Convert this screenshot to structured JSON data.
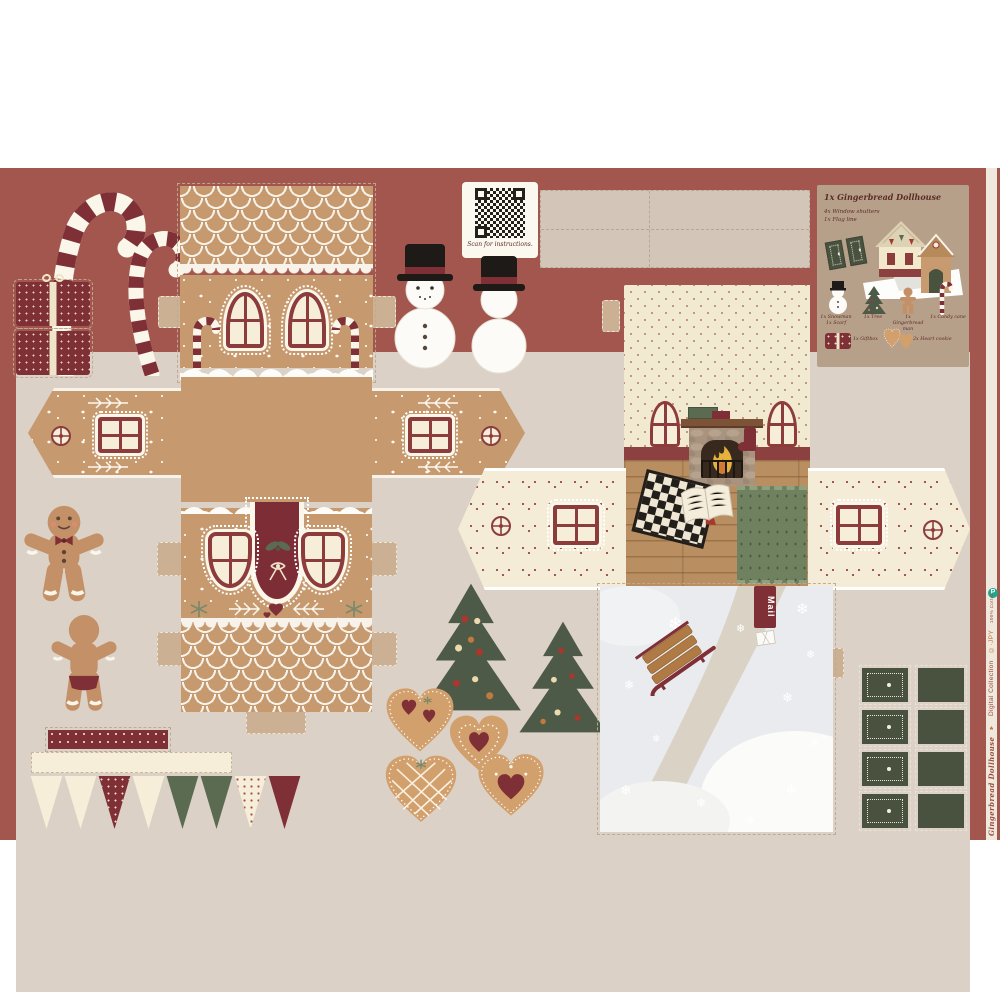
{
  "colors": {
    "border": "#a2564e",
    "panel_bg": "#dcd1c6",
    "gingerbread_tan": "#c6996f",
    "maroon": "#7f2f36",
    "window_frame": "#8d3c3c",
    "cream": "#f6eed9",
    "wallpaper_cream": "#f1e9d0",
    "shutter_green": "#48523f",
    "tree_green": "#4d5a47",
    "rug_green": "#70815f",
    "info_panel_taupe": "#b7a089",
    "snow_gray": "#e9ebee",
    "wood_floor": "#b98e60",
    "logo_teal": "#1ea78f",
    "page_bg": "#ffffff"
  },
  "qr_block": {
    "caption": "Scan for instructions."
  },
  "info_panel": {
    "title": "1x Gingerbread Dollhouse",
    "subtitle1": "4x Window shutters",
    "subtitle2": "1x Flag line",
    "items": [
      {
        "icon": "snowman-icon",
        "line1": "1x Snowman",
        "line2": "1x Scarf"
      },
      {
        "icon": "tree-icon",
        "line1": "1x Tree",
        "line2": ""
      },
      {
        "icon": "gingerbread-man-icon",
        "line1": "1x Gingerbread",
        "line2": "man"
      },
      {
        "icon": "candy-cane-icon",
        "line1": "1x Candy cane",
        "line2": ""
      },
      {
        "icon": "giftbox-icon",
        "line1": "1x Giftbox",
        "line2": ""
      },
      {
        "icon": "heart-cookie-icon",
        "line1": "2x Heart cookie",
        "line2": ""
      }
    ]
  },
  "yard": {
    "mail_flag_label": "Mail"
  },
  "selvage": {
    "brand_script": "Gingerbread Dollhouse",
    "heart_glyph": "♥",
    "collection": "Digital Collection",
    "maker": "©·JPY",
    "fine_print": "100% Cotton",
    "logo_letter": "P"
  }
}
